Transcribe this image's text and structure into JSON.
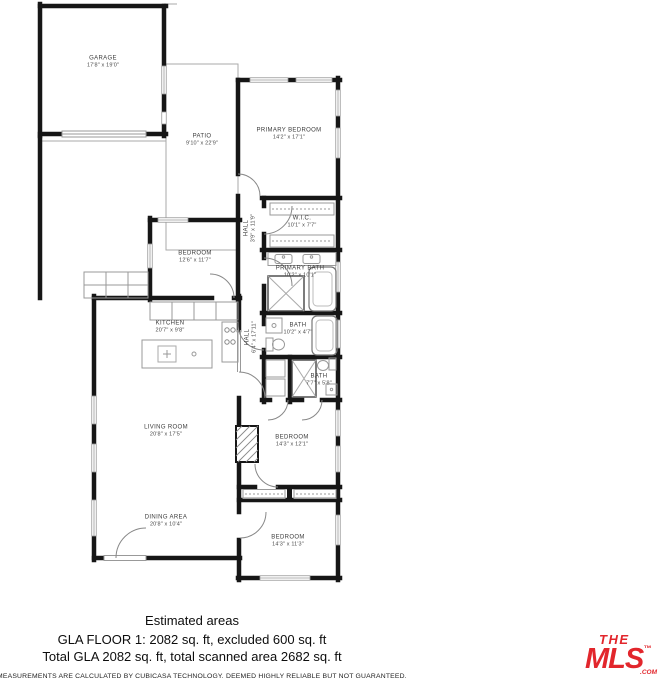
{
  "rooms": [
    {
      "name": "GARAGE",
      "dims": "17'8\" x 19'0\""
    },
    {
      "name": "PATIO",
      "dims": "9'10\" x 22'9\""
    },
    {
      "name": "PRIMARY BEDROOM",
      "dims": "14'2\" x 17'1\""
    },
    {
      "name": "HALL",
      "dims": "3'9\" x 11'9\""
    },
    {
      "name": "W.I.C.",
      "dims": "10'1\" x 7'7\""
    },
    {
      "name": "BEDROOM",
      "dims": "12'6\" x 11'7\""
    },
    {
      "name": "PRIMARY BATH",
      "dims": "10'2\" x 10'1\""
    },
    {
      "name": "KITCHEN",
      "dims": "20'7\" x 9'8\""
    },
    {
      "name": "HALL",
      "dims": "6'4\" x 17'11\""
    },
    {
      "name": "BATH",
      "dims": "10'2\" x 4'7\""
    },
    {
      "name": "BATH",
      "dims": "7'7\" x 5'8\""
    },
    {
      "name": "LIVING ROOM",
      "dims": "20'8\" x 17'5\""
    },
    {
      "name": "BEDROOM",
      "dims": "14'3\" x 12'1\""
    },
    {
      "name": "DINING AREA",
      "dims": "20'8\" x 10'4\""
    },
    {
      "name": "BEDROOM",
      "dims": "14'3\" x 11'3\""
    }
  ],
  "footer": {
    "estimated_title": "Estimated areas",
    "gla_line1": "GLA FLOOR 1: 2082 sq. ft, excluded 600 sq. ft",
    "gla_line2": "Total GLA 2082 sq. ft, total scanned area 2682 sq. ft",
    "disclaimer": "MEASUREMENTS ARE CALCULATED BY CUBICASA TECHNOLOGY. DEEMED HIGHLY RELIABLE BUT NOT GUARANTEED."
  },
  "logo": {
    "the": "THE",
    "mls": "MLS",
    "tm": "™",
    "com": ".COM",
    "color": "#e2262c"
  }
}
